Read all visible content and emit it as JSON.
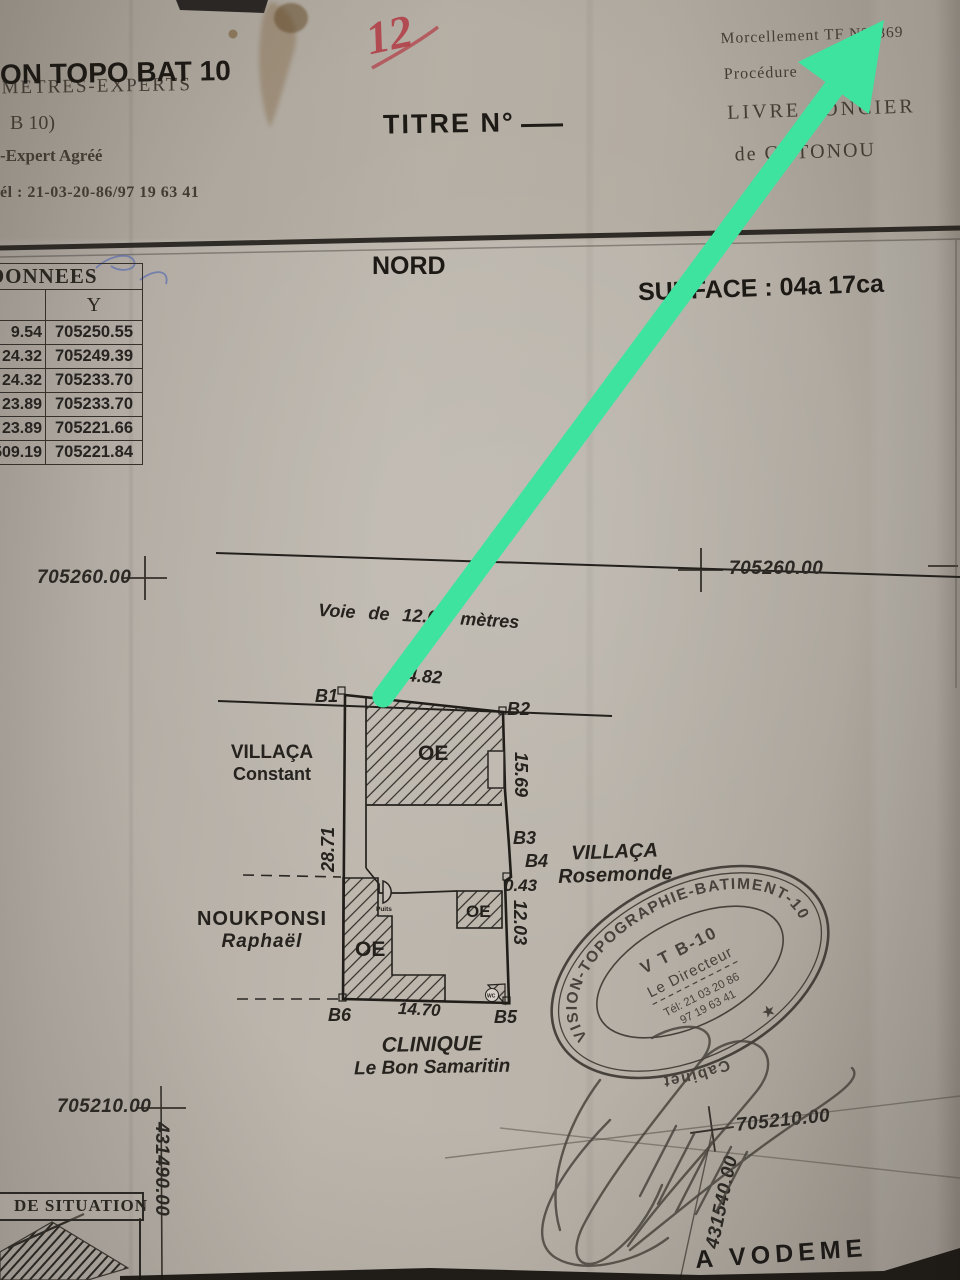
{
  "colors": {
    "arrow": "#3fe3a0",
    "ink": "#26221d",
    "red": "#b23a45"
  },
  "header": {
    "left": {
      "l1": "METRES-EXPERTS",
      "l2": "ON TOPO BAT 10",
      "l3": "B 10)",
      "l4": "-Expert Agréé",
      "l5": "él : 21-03-20-86/97 19 63 41"
    },
    "center": {
      "title": "TITRE N°"
    },
    "right": {
      "l1": "Morcellement TF N°1869",
      "l2": "Procédure",
      "l3": "LIVRE FONCIER",
      "l4": "de COTONOU"
    },
    "handwritten": "12"
  },
  "section": {
    "nord": "NORD",
    "surface": "SURFACE : 04a 17ca"
  },
  "table": {
    "header": "DONNEES",
    "col_y": "Y",
    "rows": [
      [
        "9.54",
        "705250.55"
      ],
      [
        "24.32",
        "705249.39"
      ],
      [
        "24.32",
        "705233.70"
      ],
      [
        "23.89",
        "705233.70"
      ],
      [
        "23.89",
        "705221.66"
      ],
      [
        "509.19",
        "705221.84"
      ]
    ]
  },
  "grid": {
    "top_left": "705260.00",
    "top_right": "705260.00",
    "bottom_left": "705210.00",
    "bottom_right": "705210.00",
    "x_left": "431490.00",
    "x_right": "431540.00"
  },
  "plan": {
    "road": "Voie de 12.00 mètres",
    "dim_top": "14.82",
    "dim_right_upper": "15.69",
    "dim_left": "28.71",
    "dim_right_lower": "12.03",
    "dim_bottom": "14.70",
    "dim_offset": "0.43",
    "b1": "B1",
    "b2": "B2",
    "b3": "B3",
    "b4": "B4",
    "b5": "B5",
    "b6": "B6",
    "oe": "OE",
    "puits": "Puits",
    "wc": "WC",
    "neighbors": {
      "west1": "VILLAÇA",
      "west2": "Constant",
      "southwest1": "NOUKPONSI",
      "southwest2": "Raphaël",
      "east1": "VILLAÇA",
      "east2": "Rosemonde",
      "south1": "CLINIQUE",
      "south2": "Le Bon Samaritin"
    }
  },
  "stamp": {
    "ring_top": "VISION-TOPOGRAPHIE-BATIMENT-10",
    "ring_bottom": "Cabinet",
    "line1": "V T B-10",
    "line2": "Le Directeur",
    "line3": "Tél: 21 03 20 86",
    "line4": "97 19 63 41",
    "star": "★"
  },
  "situation": {
    "title": "DE SITUATION"
  },
  "footer": {
    "place": "A VODEME"
  }
}
